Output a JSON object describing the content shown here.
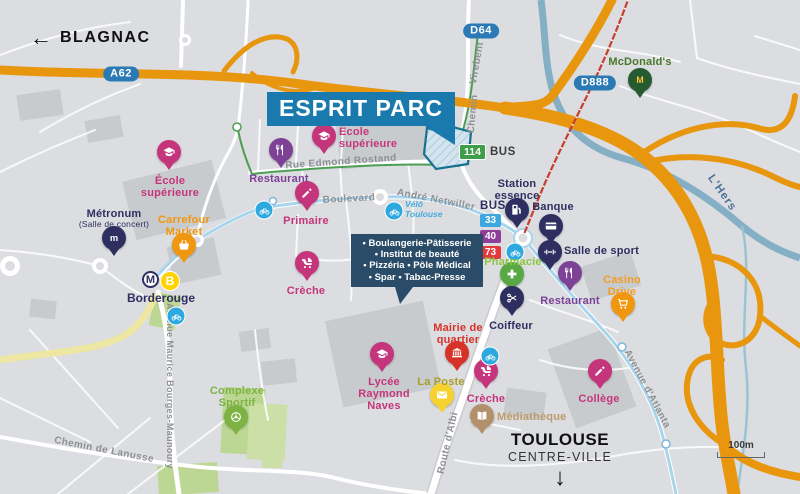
{
  "banner": {
    "text": "ESPRIT PARC"
  },
  "directions": {
    "blagnac": "BLAGNAC",
    "toulouse_line1": "TOULOUSE",
    "toulouse_line2": "CENTRE-VILLE"
  },
  "icons": {
    "west_arrow": "←",
    "south_arrow": "↓"
  },
  "river_label": "L'Hers",
  "scale": {
    "label": "100m"
  },
  "services_box": {
    "lines": [
      "• Boulangerie-Pâtisserie",
      "• Institut de beauté",
      "• Pizzéria • Pôle Médical",
      "• Spar • Tabac-Presse"
    ]
  },
  "bus": {
    "label": "BUS",
    "routes": [
      {
        "num": "33",
        "color": "#3FA7E0"
      },
      {
        "num": "40",
        "color": "#8F3E97"
      },
      {
        "num": "73",
        "color": "#E23A3C"
      }
    ],
    "line114": {
      "num": "114",
      "color": "#3F9E49",
      "label": "BUS"
    }
  },
  "metro": {
    "m": "M",
    "line": "B",
    "station": "Borderouge"
  },
  "velo": {
    "line1": "Vélô",
    "line2": "Toulouse"
  },
  "shields": [
    {
      "id": "a62",
      "label": "A62",
      "x": 121,
      "y": 74
    },
    {
      "id": "d64",
      "label": "D64",
      "x": 481,
      "y": 31
    },
    {
      "id": "d888",
      "label": "D888",
      "x": 595,
      "y": 83
    }
  ],
  "streets": [
    {
      "id": "rue-edmond-rostand",
      "label": "Rue Edmond Rostand",
      "x": 341,
      "y": 162,
      "rot": -4
    },
    {
      "id": "boulevard",
      "label": "Boulevard",
      "x": 349,
      "y": 199,
      "rot": -3
    },
    {
      "id": "andre-netwiller",
      "label": "André Netwiller",
      "x": 436,
      "y": 200,
      "rot": 11
    },
    {
      "id": "chemin-virebent-chemin",
      "label": "Chemin",
      "x": 473,
      "y": 114,
      "rot": -85
    },
    {
      "id": "chemin-virebent-virebent",
      "label": "Virebent",
      "x": 477,
      "y": 63,
      "rot": -80
    },
    {
      "id": "route-albi",
      "label": "Route d'Albi",
      "x": 448,
      "y": 443,
      "rot": -77
    },
    {
      "id": "avenue-atlanta",
      "label": "Avenue d'Atlanta",
      "x": 647,
      "y": 389,
      "rot": 62
    },
    {
      "id": "avenue-maurice-bourges-maunoury",
      "label": "Avenue Maurice Bourges-Maunoury",
      "x": 170,
      "y": 386,
      "rot": 90,
      "size": 9
    },
    {
      "id": "chemin-de-lanusse",
      "label": "Chemin de Lanusse",
      "x": 104,
      "y": 450,
      "rot": 11
    }
  ],
  "pois": [
    {
      "id": "ecole-superieure-nord",
      "label": "École\nsupérieure",
      "icon": "graduation-cap",
      "pin": "#C5357C",
      "label_color": "#C5357C",
      "x": 169,
      "y": 172,
      "lx": 170,
      "ly": 175,
      "lpos": "below"
    },
    {
      "id": "metronum",
      "label": "Métronum",
      "sub": "(Salle de concert)",
      "icon": "letter-m",
      "pin": "#2E2E60",
      "label_color": "#2E2E60",
      "x": 114,
      "y": 258,
      "lx": 114,
      "ly": 208,
      "lpos": "above"
    },
    {
      "id": "carrefour-market",
      "label": "Carrefour\nMarket",
      "icon": "shopping-basket",
      "pin": "#F0960F",
      "label_color": "#F0960F",
      "x": 184,
      "y": 265,
      "lx": 184,
      "ly": 214,
      "lpos": "above"
    },
    {
      "id": "restaurant-ouest",
      "label": "Restaurant",
      "icon": "cutlery",
      "pin": "#7D4196",
      "label_color": "#7D4196",
      "x": 281,
      "y": 170,
      "lx": 279,
      "ly": 173,
      "lpos": "below"
    },
    {
      "id": "ecole-superieure-centre",
      "label": "École\nsupérieure",
      "icon": "graduation-cap",
      "pin": "#C5357C",
      "label_color": "#C5357C",
      "x": 324,
      "y": 156,
      "lx": 339,
      "ly": 126,
      "lpos": "right"
    },
    {
      "id": "primaire",
      "label": "Primaire",
      "icon": "pencil",
      "pin": "#C5357C",
      "label_color": "#C5357C",
      "x": 307,
      "y": 213,
      "lx": 306,
      "ly": 215,
      "lpos": "below"
    },
    {
      "id": "creche-ouest",
      "label": "Crèche",
      "icon": "pram",
      "pin": "#C5357C",
      "label_color": "#C5357C",
      "x": 307,
      "y": 283,
      "lx": 306,
      "ly": 285,
      "lpos": "below"
    },
    {
      "id": "station-essence",
      "label": "Station\nessence",
      "icon": "fuel-pump",
      "pin": "#2E2E60",
      "label_color": "#2E2E60",
      "x": 517,
      "y": 230,
      "lx": 517,
      "ly": 178,
      "lpos": "above"
    },
    {
      "id": "banque",
      "label": "Banque",
      "icon": "bank-card",
      "pin": "#2E2E60",
      "label_color": "#2E2E60",
      "x": 551,
      "y": 246,
      "lx": 553,
      "ly": 201,
      "lpos": "above"
    },
    {
      "id": "salle-de-sport",
      "label": "Salle de sport",
      "icon": "dumbbell",
      "pin": "#2E2E60",
      "label_color": "#2E2E60",
      "x": 550,
      "y": 272,
      "lx": 564,
      "ly": 245,
      "lpos": "right"
    },
    {
      "id": "pharmacie",
      "label": "Pharmacie",
      "icon": "medical-cross",
      "pin": "#58A846",
      "label_color": "#8DC63F",
      "x": 512,
      "y": 294,
      "lx": 513,
      "ly": 256,
      "lpos": "above"
    },
    {
      "id": "coiffeur",
      "label": "Coiffeur",
      "icon": "scissors",
      "pin": "#2E2E60",
      "label_color": "#2E2E60",
      "x": 512,
      "y": 318,
      "lx": 511,
      "ly": 320,
      "lpos": "below"
    },
    {
      "id": "restaurant-est",
      "label": "Restaurant",
      "icon": "cutlery",
      "pin": "#7D4196",
      "label_color": "#7D4196",
      "x": 570,
      "y": 293,
      "lx": 570,
      "ly": 295,
      "lpos": "below"
    },
    {
      "id": "casino-drive",
      "label": "Casino\nDrive",
      "icon": "shopping-cart",
      "pin": "#F0960F",
      "label_color": "#F49B1F",
      "x": 623,
      "y": 324,
      "lx": 622,
      "ly": 274,
      "lpos": "above"
    },
    {
      "id": "mcdonalds",
      "label": "McDonald's",
      "icon": "mcdonalds-arches",
      "pin": "#265B31",
      "label_color": "#4A7729",
      "x": 640,
      "y": 100,
      "lx": 640,
      "ly": 56,
      "lpos": "above"
    },
    {
      "id": "mairie-de-quartier",
      "label": "Mairie de\nquartier",
      "icon": "town-hall",
      "pin": "#D63228",
      "label_color": "#D63228",
      "x": 457,
      "y": 373,
      "lx": 458,
      "ly": 322,
      "lpos": "above"
    },
    {
      "id": "la-poste",
      "label": "La Poste",
      "icon": "envelope",
      "pin": "#F5D22F",
      "label_color": "#A99E27",
      "x": 442,
      "y": 415,
      "lx": 441,
      "ly": 376,
      "lpos": "above"
    },
    {
      "id": "lycee-raymond-naves",
      "label": "Lycée\nRaymond\nNaves",
      "icon": "graduation-cap",
      "pin": "#C5357C",
      "label_color": "#C5357C",
      "x": 382,
      "y": 374,
      "lx": 384,
      "ly": 376,
      "lpos": "below"
    },
    {
      "id": "creche-centre",
      "label": "Crèche",
      "icon": "pram",
      "pin": "#C5357C",
      "label_color": "#C5357C",
      "x": 486,
      "y": 391,
      "lx": 486,
      "ly": 393,
      "lpos": "below"
    },
    {
      "id": "mediatheque",
      "label": "Médiathèque",
      "icon": "open-book",
      "pin": "#B3906B",
      "label_color": "#BD9B6B",
      "x": 482,
      "y": 436,
      "lx": 497,
      "ly": 411,
      "lpos": "right"
    },
    {
      "id": "college",
      "label": "Collège",
      "icon": "pencil",
      "pin": "#C5357C",
      "label_color": "#C5357C",
      "x": 600,
      "y": 391,
      "lx": 599,
      "ly": 393,
      "lpos": "below"
    },
    {
      "id": "complexe-sportif",
      "label": "Complexe\nSportif",
      "icon": "sports-ball",
      "pin": "#7DB343",
      "label_color": "#7DB343",
      "x": 236,
      "y": 437,
      "lx": 237,
      "ly": 385,
      "lpos": "above"
    }
  ],
  "bike_stations": [
    {
      "x": 264,
      "y": 210
    },
    {
      "x": 394,
      "y": 211
    },
    {
      "x": 515,
      "y": 252
    },
    {
      "x": 176,
      "y": 316
    },
    {
      "x": 490,
      "y": 356
    }
  ],
  "colors": {
    "banner_blue": "#1B7AAD",
    "shield_blue": "#2B7AB5",
    "motorway_orange": "#E8960E",
    "river_blue": "#84AFC4",
    "transit_blue": "#A9D5EC",
    "bus114_green": "#3F9E49",
    "railway_red": "#C4402F",
    "education_pink": "#C5357C",
    "services_navy": "#2E2E60",
    "restaurant_purple": "#7D4196",
    "bike_blue": "#2EA9E0",
    "metro_yellow": "#FFD200"
  }
}
